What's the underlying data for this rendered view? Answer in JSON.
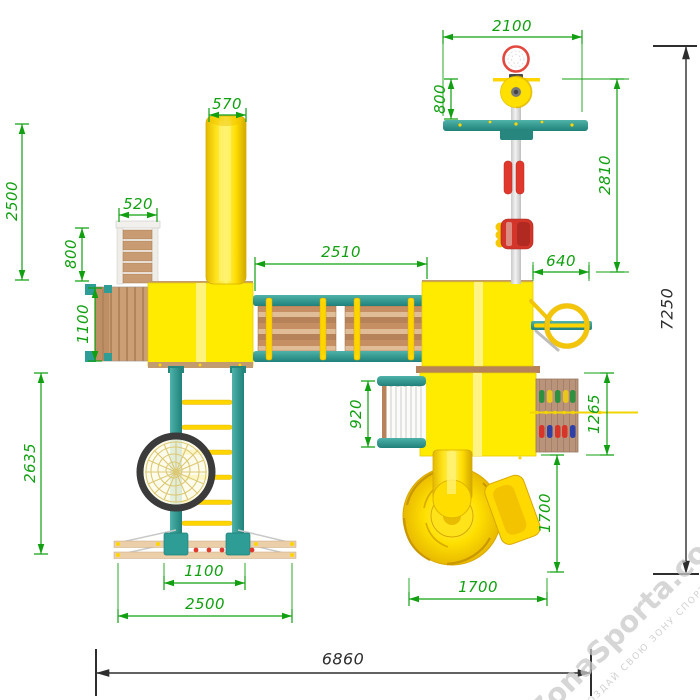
{
  "dimensions": {
    "slide_width_570": "570",
    "slide_length_2500": "2500",
    "stairs_width_520": "520",
    "stairs_length_800": "800",
    "platform_1100": "1100",
    "bridge_2510": "2510",
    "basket_beam_2100": "2100",
    "hoop_offset_800": "800",
    "mast_2810": "2810",
    "side_offset_640": "640",
    "total_depth_7250": "7250",
    "net_920": "920",
    "panel_1265": "1265",
    "spiral_depth_1700": "1700",
    "spiral_width_1700": "1700",
    "ladder_2635": "2635",
    "ladder_base_1100": "1100",
    "base_2500": "2500",
    "total_width_6860": "6860"
  },
  "watermark": {
    "brand": "ZonaSporta.com",
    "slogan": "СОЗДАЙ СВОЮ ЗОНУ СПОРТА"
  },
  "colors": {
    "dimension_green": "#12A012",
    "dimension_black": "#2E2E2E",
    "tower_yellow": "#FFEB00",
    "beam_teal": "#2E9D95",
    "wood_brown": "#C68F63",
    "accent_red": "#E0382C"
  }
}
